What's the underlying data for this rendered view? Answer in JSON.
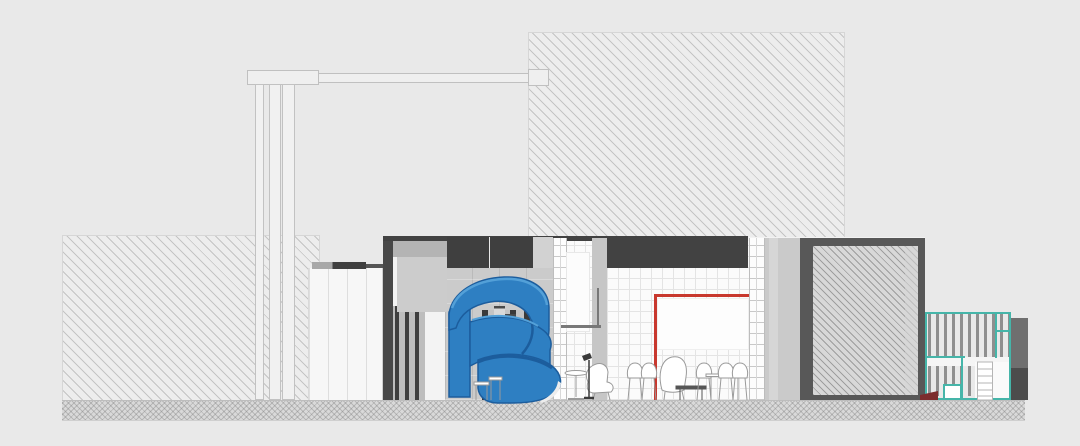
{
  "scene": {
    "kind": "architectural-section-elevation",
    "visible_text": [],
    "elements": [
      {
        "name": "background-building-block",
        "fill": "light diagonal hatch"
      },
      {
        "name": "site-wall-left",
        "fill": "light diagonal hatch"
      },
      {
        "name": "pergola-frame",
        "parts": [
          "header box",
          "horizontal beam",
          "end box",
          "three posts"
        ]
      },
      {
        "name": "white-screen-panel",
        "detail": "vertical battens with dark cap"
      },
      {
        "name": "building-section",
        "detail": "dark cut roof band, concrete blocks, tile walls"
      },
      {
        "name": "blue-spiral-slide",
        "color_ref": "blue_main"
      },
      {
        "name": "louver-screens",
        "detail": "dark vertical slats"
      },
      {
        "name": "glass-block-columns",
        "count": 2
      },
      {
        "name": "red-portal-frame",
        "color_ref": "red_accent"
      },
      {
        "name": "projection-board",
        "fill": "white"
      },
      {
        "name": "furniture",
        "items": [
          "stool",
          "side table",
          "pedestal table",
          "lounge chair",
          "floor lamp",
          "side chairs",
          "lounge chair",
          "coffee table",
          "dining table with chairs"
        ]
      },
      {
        "name": "framed-hatch-block",
        "fill": "dense hatch with dark frame"
      },
      {
        "name": "teal-pavilion",
        "parts": [
          "teal frame",
          "slat bands",
          "white band",
          "ladder",
          "dark block"
        ],
        "color_ref": "teal_accent"
      },
      {
        "name": "maroon-step",
        "color_ref": "maroon"
      },
      {
        "name": "ground-strip",
        "fill": "cross hatch"
      }
    ]
  },
  "colors": {
    "background": "#e9e9e9",
    "hatch_base": "#ededed",
    "ground_base": "#d9d9d9",
    "charcoal_band": "#424242",
    "dark_wall": "#484848",
    "concrete": "#cbcbcb",
    "concrete_dark": "#b4b4b4",
    "panel_white": "#f7f7f7",
    "blue_main": "#2e7fc2",
    "blue_dark": "#1c5d9d",
    "blue_light": "#53a0d8",
    "red_accent": "#c8382e",
    "teal_accent": "#45b5a9",
    "maroon": "#7c2d2d",
    "furniture_stroke": "#9a9a9a"
  }
}
